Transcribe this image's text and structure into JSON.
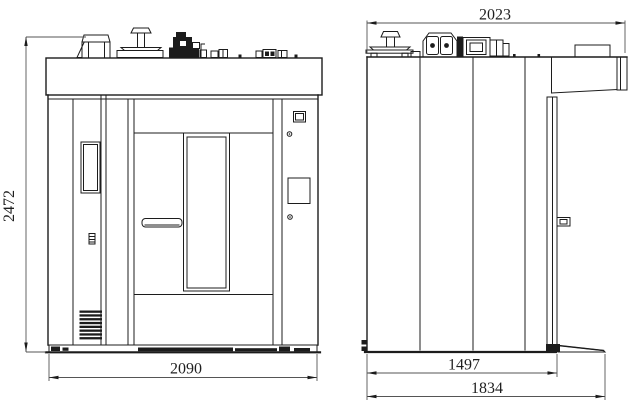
{
  "drawing": {
    "kind": "two-view technical drawing",
    "dimensions": {
      "overall_height": "2472",
      "front_overall_width": "2090",
      "side_top_overall_depth": "2023",
      "side_body_depth": "1497",
      "side_overall_depth_with_ramp": "1834"
    },
    "colors": {
      "line": "#1c1c1c",
      "background": "#ffffff",
      "text": "#1f1f1f"
    }
  }
}
